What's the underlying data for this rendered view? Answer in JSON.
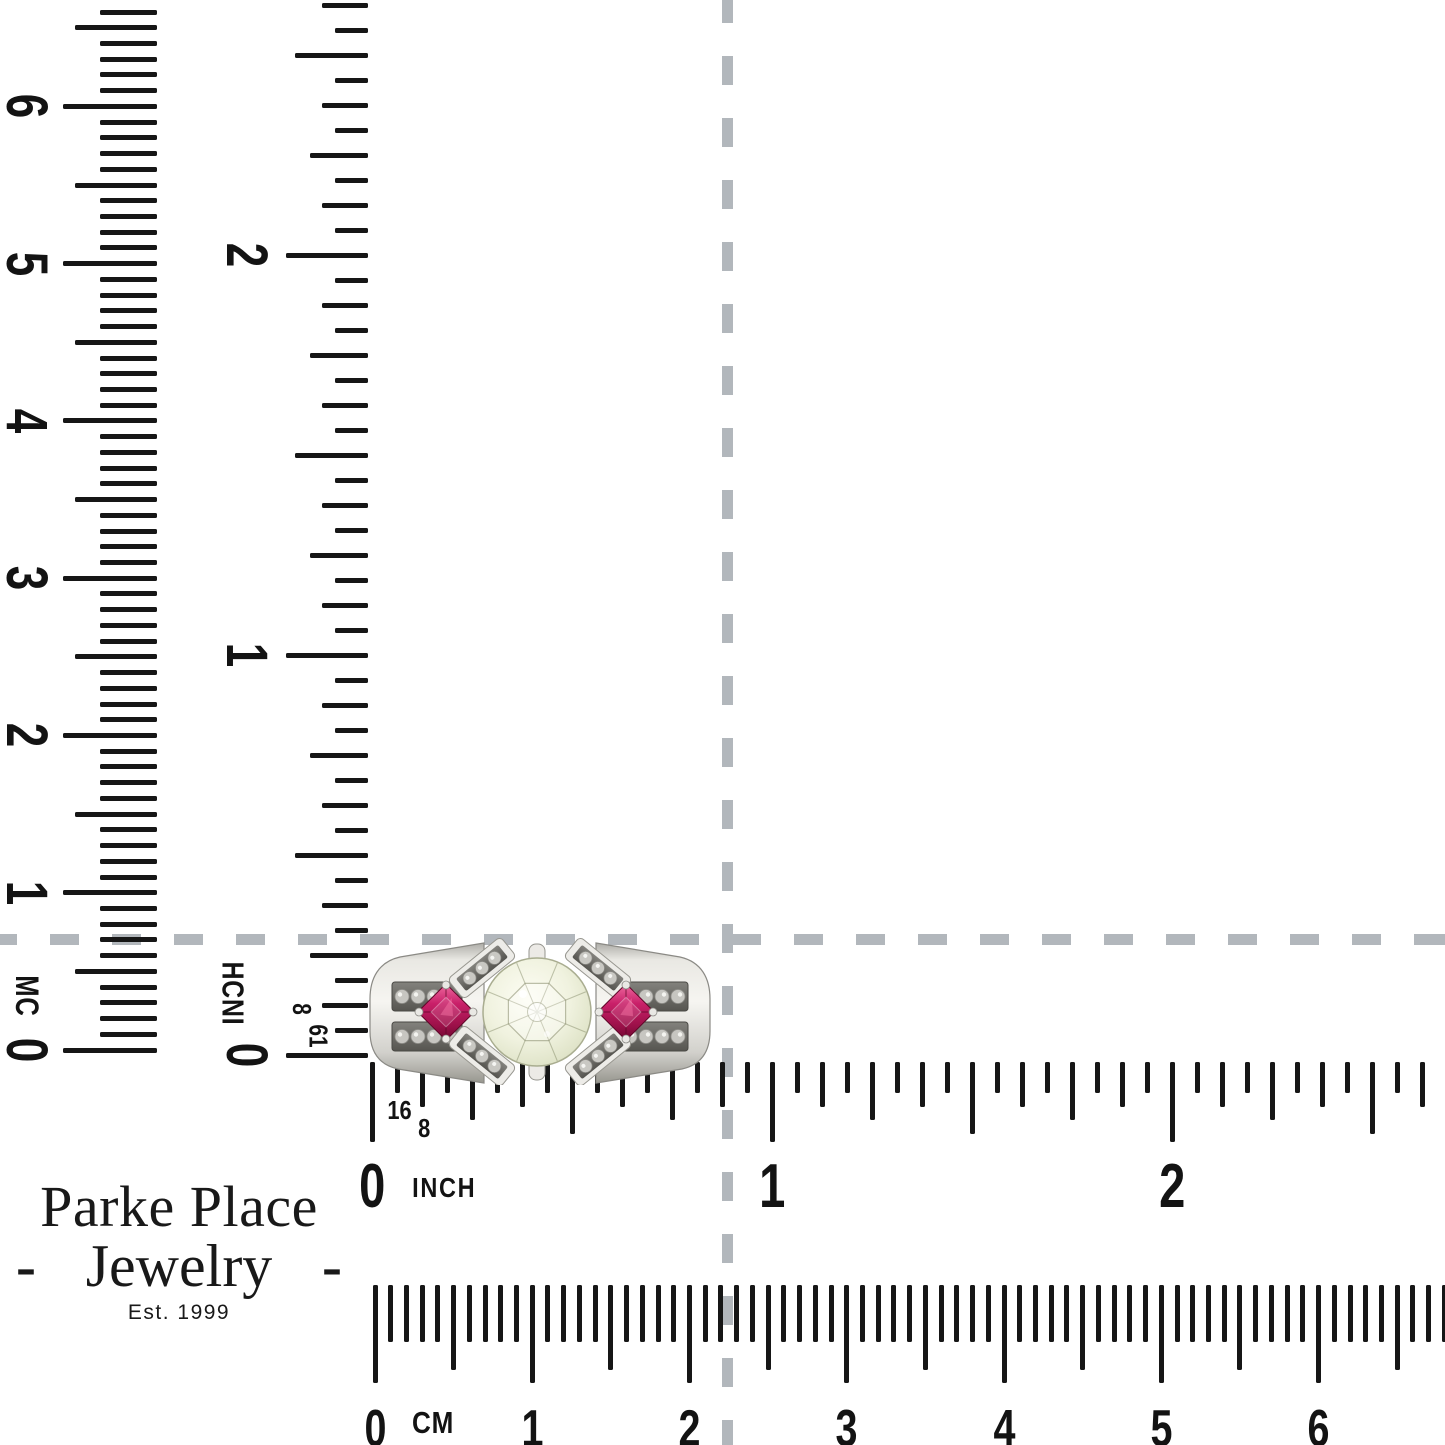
{
  "crosshair": {
    "color": "#b2b7bc"
  },
  "tick_color": "#161616",
  "rulers": {
    "vertical_cm": {
      "unit": "CM",
      "numbers": [
        "0",
        "1",
        "2",
        "3",
        "4",
        "5",
        "6"
      ]
    },
    "vertical_inch": {
      "unit": "INCH",
      "numbers": [
        "0",
        "1",
        "2"
      ],
      "eighth_label": "8",
      "sixteenth_label": "16"
    },
    "horizontal_inch": {
      "unit": "INCH",
      "numbers": [
        "0",
        "1",
        "2"
      ],
      "eighth_label": "8",
      "sixteenth_label": "16"
    },
    "horizontal_cm": {
      "unit": "CM",
      "numbers": [
        "0",
        "1",
        "2",
        "3",
        "4",
        "5",
        "6"
      ]
    }
  },
  "ring_colors": {
    "metal": "#edece8",
    "metal_shadow": "#98978f",
    "center_stone_tint": "#eef0dd",
    "ruby": "#b91a55",
    "ruby_dark": "#6d0730",
    "channel": "#6f6e69",
    "accent_stone": "#c9c8c3"
  },
  "ring_alt": "diamond-and-ruby-ring",
  "branding": {
    "line1": "Parke Place",
    "line2": "Jewelry",
    "dash": "-",
    "est": "Est. 1999",
    "gold": "#c49b2e"
  }
}
